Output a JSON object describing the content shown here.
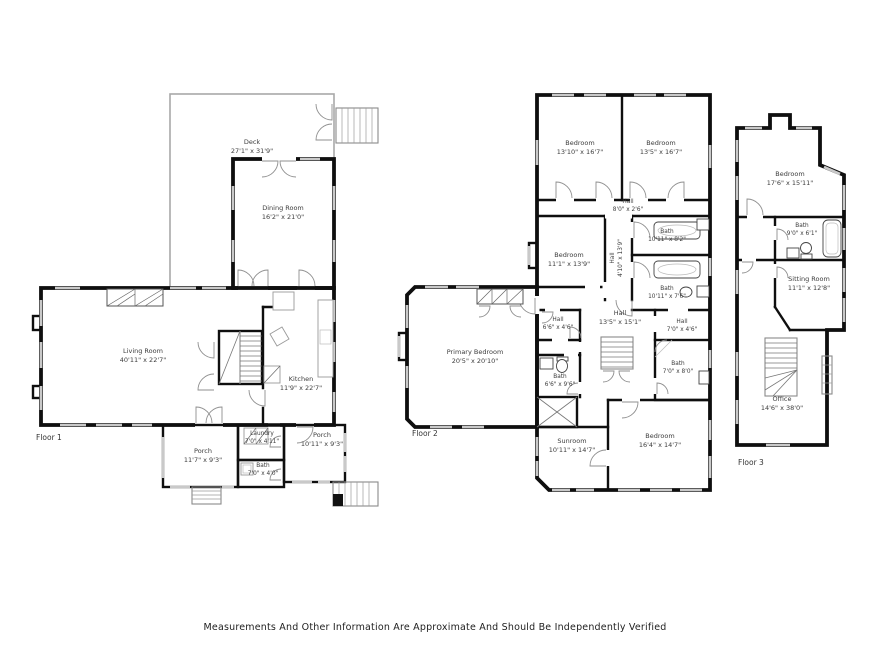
{
  "disclaimer": "Measurements And Other Information Are Approximate And Should Be Independently Verified",
  "colors": {
    "wall": "#0f0f0f",
    "window": "#c9c9c9",
    "deck_outline": "#a8a8a8"
  },
  "floor1": {
    "label": "Floor 1",
    "rooms": {
      "deck": {
        "name": "Deck",
        "dims": "27'1\" x 31'9\""
      },
      "dining_room": {
        "name": "Dining Room",
        "dims": "16'2\" x 21'0\""
      },
      "living_room": {
        "name": "Living Room",
        "dims": "40'11\" x 22'7\""
      },
      "kitchen": {
        "name": "Kitchen",
        "dims": "11'9\" x 22'7\""
      },
      "laundry": {
        "name": "Laundry",
        "dims": "7'0\" x 4'11\""
      },
      "bath": {
        "name": "Bath",
        "dims": "7'0\" x 4'0\""
      },
      "porch_left": {
        "name": "Porch",
        "dims": "11'7\" x 9'3\""
      },
      "porch_right": {
        "name": "Porch",
        "dims": "10'11\" x 9'3\""
      }
    }
  },
  "floor2": {
    "label": "Floor 2",
    "rooms": {
      "bedroom_top_left": {
        "name": "Bedroom",
        "dims": "13'10\" x 16'7\""
      },
      "bedroom_top_right": {
        "name": "Bedroom",
        "dims": "13'5\" x 16'7\""
      },
      "hall_top": {
        "name": "Hall",
        "dims": "8'0\" x 2'6\""
      },
      "bedroom_middle": {
        "name": "Bedroom",
        "dims": "11'1\" x 13'9\""
      },
      "bath_upper": {
        "name": "Bath",
        "dims": "10'11\" x 8'2\""
      },
      "bath_lower": {
        "name": "Bath",
        "dims": "10'11\" x 7'6\""
      },
      "hall_vertical": {
        "name": "Hall",
        "dims": "4'10\" x 13'9\""
      },
      "primary_bedroom": {
        "name": "Primary Bedroom",
        "dims": "20'5\" x 20'10\""
      },
      "hall_small": {
        "name": "Hall",
        "dims": "6'6\" x 4'6\""
      },
      "bath_primary": {
        "name": "Bath",
        "dims": "6'6\" x 9'6\""
      },
      "hall_center": {
        "name": "Hall",
        "dims": "13'5\" x 15'1\""
      },
      "hall_right": {
        "name": "Hall",
        "dims": "7'0\" x 4'6\""
      },
      "bath_right": {
        "name": "Bath",
        "dims": "7'0\" x 8'0\""
      },
      "sunroom": {
        "name": "Sunroom",
        "dims": "10'11\" x 14'7\""
      },
      "bedroom_bottom": {
        "name": "Bedroom",
        "dims": "16'4\" x 14'7\""
      }
    }
  },
  "floor3": {
    "label": "Floor 3",
    "rooms": {
      "bedroom": {
        "name": "Bedroom",
        "dims": "17'6\" x 15'11\""
      },
      "bath": {
        "name": "Bath",
        "dims": "9'0\" x 6'1\""
      },
      "sitting_room": {
        "name": "Sitting Room",
        "dims": "11'1\" x 12'8\""
      },
      "office": {
        "name": "Office",
        "dims": "14'6\" x 38'0\""
      }
    }
  }
}
